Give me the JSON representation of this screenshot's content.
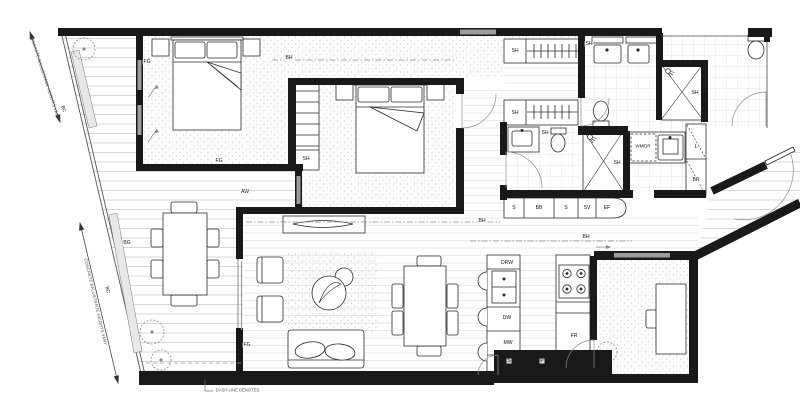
{
  "annotations": {
    "balustrade_note_top": "CONCRETE BALUSTRADE HEIGHTS VARY",
    "balustrade_note_bottom": "CONCRETE BALUSTRADE HEIGHTS VARY",
    "dash_note": "DASH LINE DENOTES"
  },
  "codes": {
    "bc_top": "BC",
    "bg": "BG",
    "bc_bottom": "BC",
    "fg_bed1_a": "FG",
    "fg_bed1_b": "FG",
    "fg_balcony": "FG",
    "bh_master": "BH",
    "bh_living": "BH",
    "bh_kitchen": "BH",
    "aw": "AW",
    "sh_bed2_robe": "SH",
    "sh_robe_row1": "SH",
    "sh_robe_row2": "SH",
    "sh_bath_mirror": "SH",
    "sh_ensuite_vanity": "SH",
    "sh_ensuite_shower": "SH",
    "sh_shower_room": "SH",
    "sink_1": "S",
    "bb": "BB",
    "sink_2": "S",
    "sv": "SV",
    "ef": "EF",
    "drw": "DRW",
    "dw": "DW",
    "mw": "MW",
    "s_island": "S",
    "p_pantry": "P",
    "fr": "FR",
    "wm_dr": "WM/DR",
    "l_linen": "L",
    "br_broom": "BR"
  }
}
